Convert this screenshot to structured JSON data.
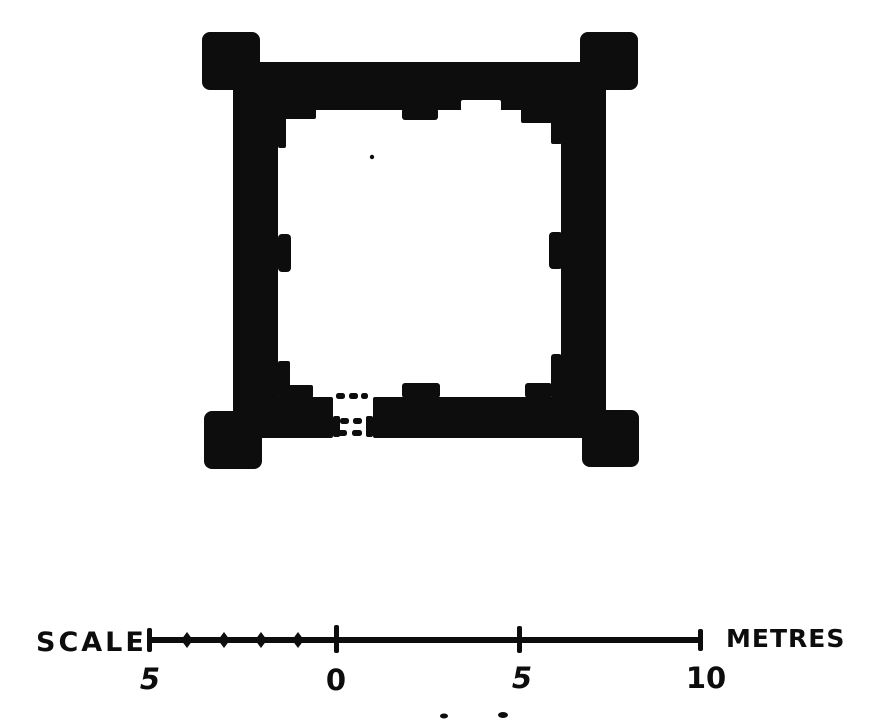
{
  "figure": {
    "subject": "ground-plan-of-square-tower-keep-with-corner-buttresses-and-doorway",
    "background_color": "#ffffff",
    "ink_color": "#0d0d0d"
  },
  "scale_bar": {
    "title": "SCALE",
    "unit_label": "METRES",
    "tick_labels": [
      "5",
      "0",
      "5",
      "10"
    ],
    "minor_divisions_left_of_zero": 5,
    "metres_left_of_zero": 5,
    "metres_right_of_zero": 10
  }
}
